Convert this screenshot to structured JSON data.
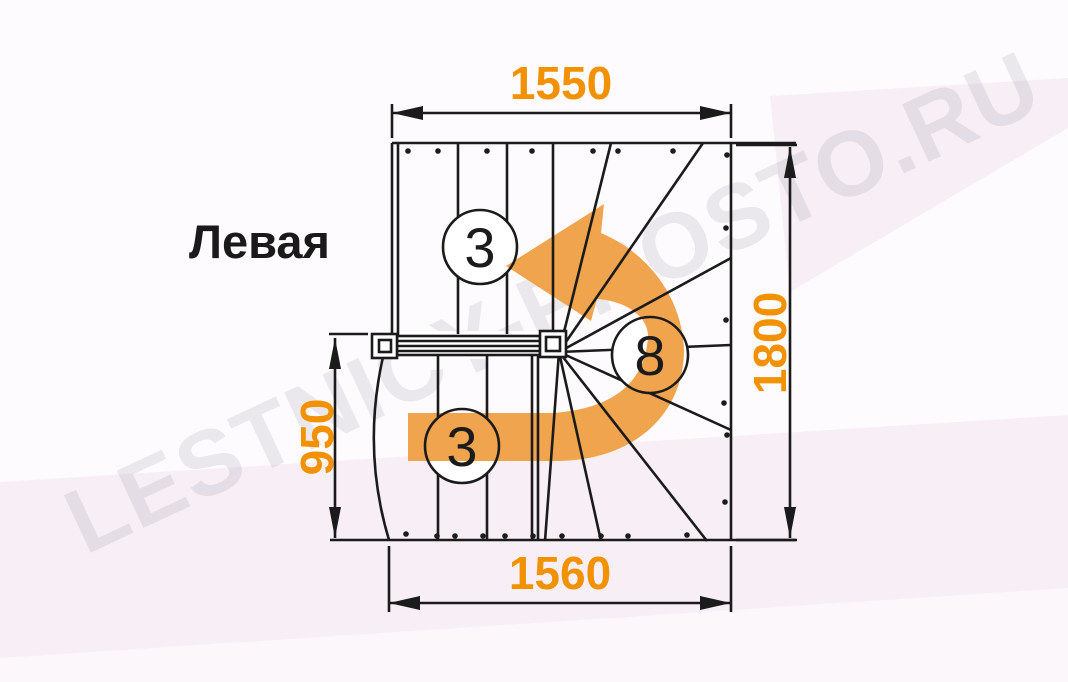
{
  "title": "Левая",
  "watermark_text": "LESTNICY-PROSTO.RU",
  "dimensions": {
    "top": "1550",
    "right": "1800",
    "left": "950",
    "bottom": "1560"
  },
  "step_labels": {
    "upper_flight": "3",
    "winder": "8",
    "lower_flight": "3"
  },
  "colors": {
    "accent": "#F29102",
    "arrow": "#F0A44E",
    "line": "#1B1B1B",
    "bg_pink": "#F7EFF5",
    "bg_white": "#FDFBFD",
    "watermark": "rgba(80,65,95,0.10)"
  }
}
